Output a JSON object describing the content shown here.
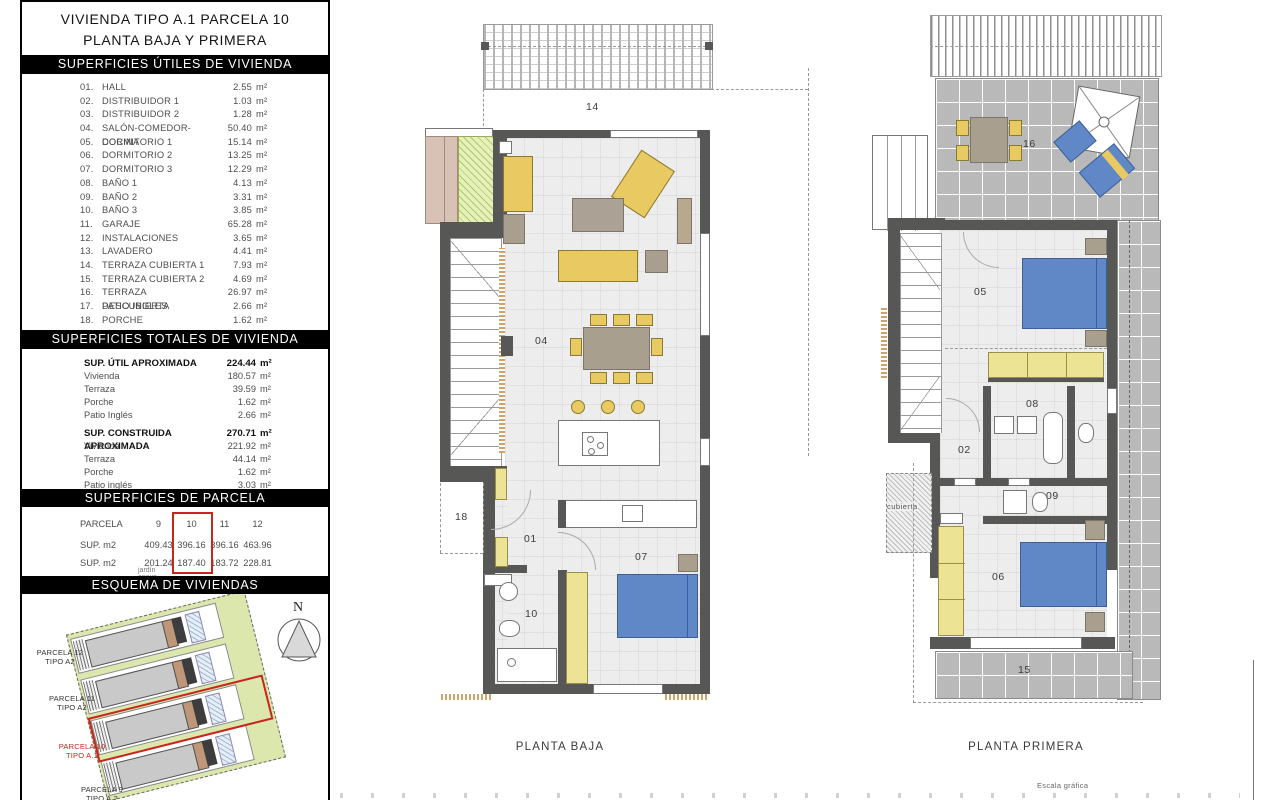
{
  "sidebar": {
    "title_line1": "VIVIENDA TIPO A.1 PARCELA 10",
    "title_line2": "PLANTA BAJA Y PRIMERA",
    "header_utiles": "SUPERFICIES ÚTILES DE VIVIENDA",
    "header_totales": "SUPERFICIES TOTALES DE VIVIENDA",
    "header_parcela": "SUPERFICIES DE PARCELA",
    "header_esquema": "ESQUEMA DE VIVIENDAS",
    "unit": "m²",
    "rooms": [
      {
        "num": "01.",
        "name": "HALL",
        "area": "2.55"
      },
      {
        "num": "02.",
        "name": "DISTRIBUIDOR 1",
        "area": "1.03"
      },
      {
        "num": "03.",
        "name": "DISTRIBUIDOR 2",
        "area": "1.28"
      },
      {
        "num": "04.",
        "name": "SALÓN-COMEDOR-COCINA",
        "area": "50.40"
      },
      {
        "num": "05.",
        "name": "DORMITORIO 1",
        "area": "15.14"
      },
      {
        "num": "06.",
        "name": "DORMITORIO 2",
        "area": "13.25"
      },
      {
        "num": "07.",
        "name": "DORMITORIO 3",
        "area": "12.29"
      },
      {
        "num": "08.",
        "name": "BAÑO 1",
        "area": "4.13"
      },
      {
        "num": "09.",
        "name": "BAÑO 2",
        "area": "3.31"
      },
      {
        "num": "10.",
        "name": "BAÑO 3",
        "area": "3.85"
      },
      {
        "num": "11.",
        "name": "GARAJE",
        "area": "65.28"
      },
      {
        "num": "12.",
        "name": "INSTALACIONES",
        "area": "3.65"
      },
      {
        "num": "13.",
        "name": "LAVADERO",
        "area": "4.41"
      },
      {
        "num": "14.",
        "name": "TERRAZA CUBIERTA 1",
        "area": "7.93"
      },
      {
        "num": "15.",
        "name": "TERRAZA CUBIERTA 2",
        "area": "4.69"
      },
      {
        "num": "16.",
        "name": "TERRAZA DESCUBIERTA",
        "area": "26.97"
      },
      {
        "num": "17.",
        "name": "PATIO INGLES",
        "area": "2.66"
      },
      {
        "num": "18.",
        "name": "PORCHE",
        "area": "1.62"
      }
    ],
    "totales": {
      "util": {
        "label": "SUP. ÚTIL APROXIMADA",
        "value": "224.44",
        "rows": [
          {
            "name": "Vivienda",
            "value": "180.57"
          },
          {
            "name": "Terraza",
            "value": "39.59"
          },
          {
            "name": "Porche",
            "value": "1.62"
          },
          {
            "name": "Patio Inglés",
            "value": "2.66"
          }
        ]
      },
      "construida": {
        "label": "SUP. CONSTRUIDA APROXIMADA",
        "value": "270.71",
        "rows": [
          {
            "name": "Vivienda",
            "value": "221.92"
          },
          {
            "name": "Terraza",
            "value": "44.14"
          },
          {
            "name": "Porche",
            "value": "1.62"
          },
          {
            "name": "Patio inglés",
            "value": "3.03"
          }
        ]
      }
    },
    "parcela_table": {
      "row_label_parcela": "PARCELA",
      "row_label_sup": "SUP. m2",
      "row_label_jardin": "SUP. m2",
      "row_label_jardin_sub": "jardín anexo",
      "cols": [
        "9",
        "10",
        "11",
        "12"
      ],
      "sup": [
        "409.43",
        "396.16",
        "396.16",
        "463.96"
      ],
      "jardin": [
        "201.24",
        "187.40",
        "183.72",
        "228.81"
      ],
      "highlighted_col": "10"
    },
    "esquema": {
      "north": "N",
      "p12_l1": "PARCELA 12",
      "p12_l2": "TIPO A2",
      "p11_l1": "PARCELA 11",
      "p11_l2": "TIPO A2",
      "p10_l1": "PARCELA 10",
      "p10_l2": "TIPO A.1",
      "p9_l1": "PARCELA 9",
      "p9_l2": "TIPO A.2"
    }
  },
  "plans": {
    "baja": {
      "caption": "PLANTA BAJA",
      "labels": {
        "terraza_cubierta1": "14",
        "salon": "04",
        "porche": "18",
        "hall": "01",
        "bano3": "10",
        "dormitorio3": "07"
      }
    },
    "primera": {
      "caption": "PLANTA PRIMERA",
      "labels": {
        "terraza_descubierta": "16",
        "dormitorio1": "05",
        "bano1": "08",
        "distribuidor1": "02",
        "bano2": "09",
        "dormitorio2": "06",
        "terraza_cubierta2": "15",
        "cubierta": "cubierta"
      }
    },
    "escala_label": "Escala gráfica"
  },
  "colors": {
    "wall": "#575756",
    "floor": "#ededed",
    "furniture_yellow": "#e9ca62",
    "wardrobe_yellow": "#ece394",
    "bed_blue": "#6088c6",
    "furniture_taupe": "#a89f8e",
    "terrace_tile": "#b9b9b9",
    "site_green": "#dbe7ad",
    "accent_red": "#c9251c"
  }
}
